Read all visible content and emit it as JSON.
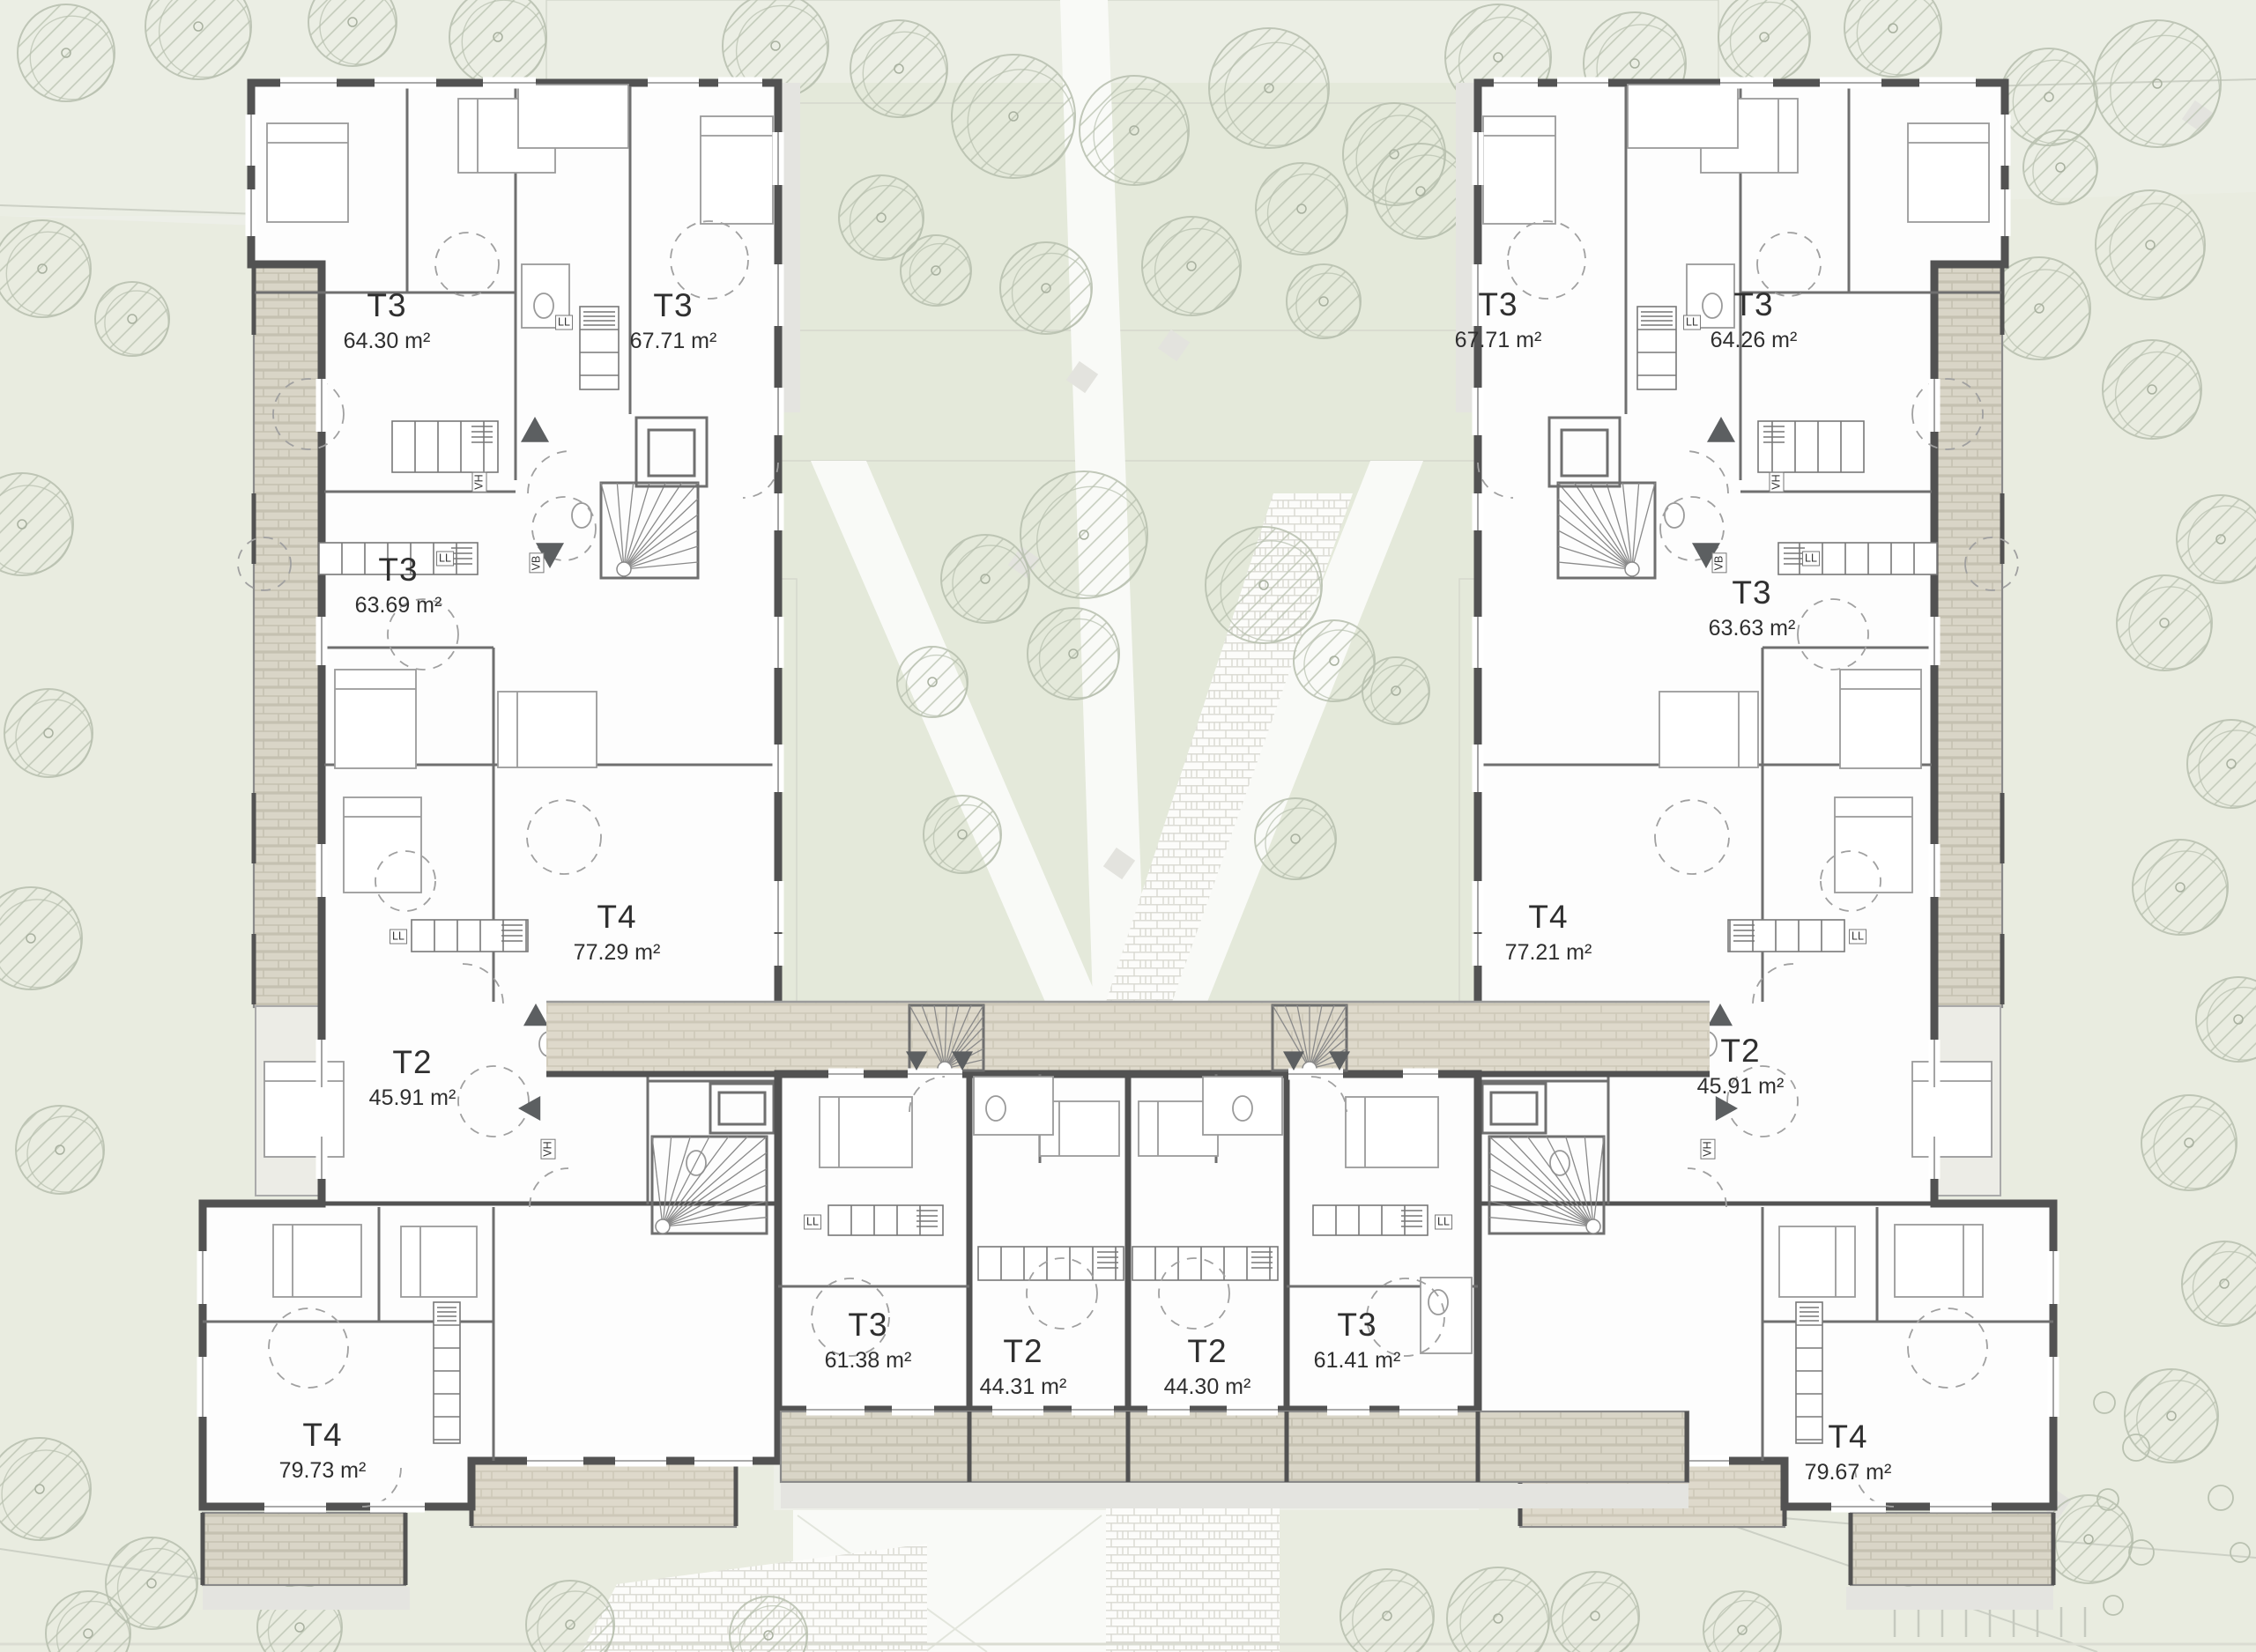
{
  "units": [
    {
      "id": "left-1",
      "type": "T3",
      "area": "64.30 m²"
    },
    {
      "id": "left-2",
      "type": "T3",
      "area": "67.71 m²"
    },
    {
      "id": "left-3",
      "type": "T3",
      "area": "63.69 m²"
    },
    {
      "id": "left-4",
      "type": "T4",
      "area": "77.29 m²"
    },
    {
      "id": "left-5",
      "type": "T2",
      "area": "45.91 m²"
    },
    {
      "id": "left-6",
      "type": "T4",
      "area": "79.73 m²"
    },
    {
      "id": "bar-1",
      "type": "T3",
      "area": "61.38 m²"
    },
    {
      "id": "bar-2",
      "type": "T2",
      "area": "44.31 m²"
    },
    {
      "id": "bar-3",
      "type": "T2",
      "area": "44.30 m²"
    },
    {
      "id": "bar-4",
      "type": "T3",
      "area": "61.41 m²"
    },
    {
      "id": "right-1",
      "type": "T3",
      "area": "67.71 m²"
    },
    {
      "id": "right-2",
      "type": "T3",
      "area": "64.26 m²"
    },
    {
      "id": "right-3",
      "type": "T3",
      "area": "63.63 m²"
    },
    {
      "id": "right-4",
      "type": "T4",
      "area": "77.21 m²"
    },
    {
      "id": "right-5",
      "type": "T2",
      "area": "45.91 m²"
    },
    {
      "id": "right-6",
      "type": "T4",
      "area": "79.67 m²"
    }
  ],
  "fixture_labels": {
    "laundry": "LL",
    "vent_high": "VH",
    "vent_low": "VB"
  },
  "colors": {
    "bg": "#edefe8",
    "courtyard_green": "#e4e9da",
    "lawn": "#e9ece0",
    "wall": "#525252",
    "building": "#fdfdfd",
    "brick": "#d9d5c7",
    "brick_line": "#c5c1b1",
    "walkway_brick": "#ded9cb",
    "walkway_line": "#cdc8b8",
    "stripe_bg": "#f3f3f0",
    "stripe_line": "#dcdcd6",
    "cobble_bg": "#fcfcfa",
    "cobble_line": "#d9d9d1",
    "path_white": "#f9faf7",
    "tree_line": "#b7bfae",
    "label_text": "#2f2f2f"
  }
}
